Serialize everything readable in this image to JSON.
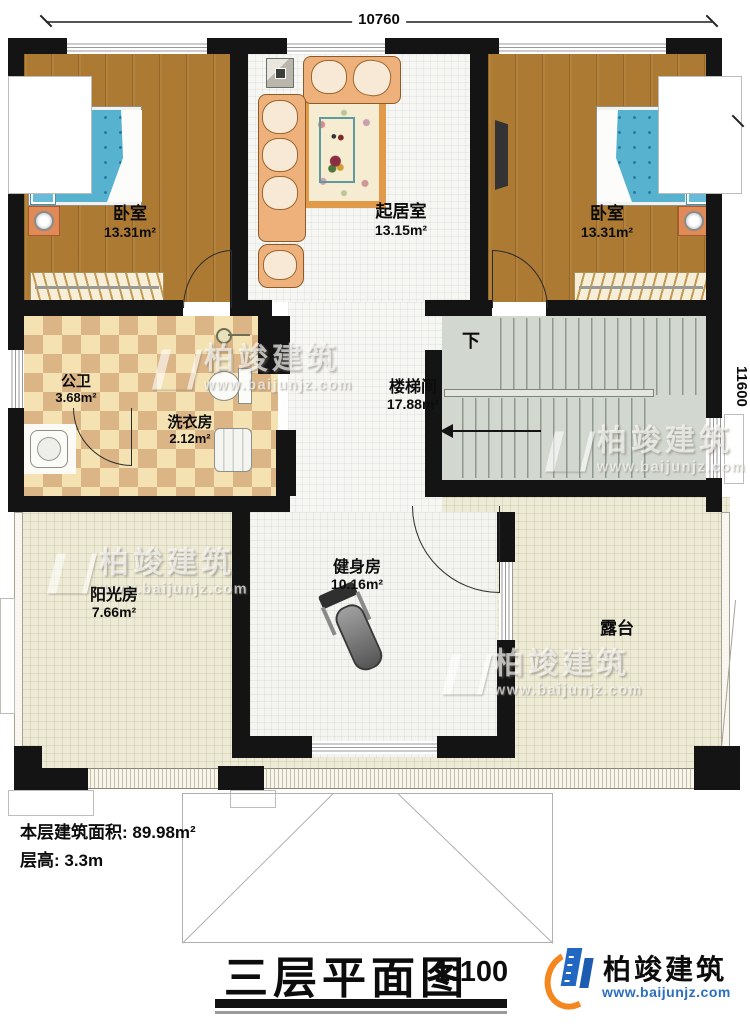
{
  "dims": {
    "width": "10760",
    "height": "11600"
  },
  "rooms": {
    "bedroom_left": {
      "name": "卧室",
      "area": "13.31m²"
    },
    "living": {
      "name": "起居室",
      "area": "13.15m²"
    },
    "bedroom_right": {
      "name": "卧室",
      "area": "13.31m²"
    },
    "bathroom": {
      "name": "公卫",
      "area": "3.68m²"
    },
    "laundry": {
      "name": "洗衣房",
      "area": "2.12m²"
    },
    "stairwell": {
      "name": "楼梯间",
      "area": "17.88m²",
      "down_label": "下"
    },
    "gym": {
      "name": "健身房",
      "area": "10.16m²"
    },
    "sunroom": {
      "name": "阳光房",
      "area": "7.66m²"
    },
    "terrace": {
      "name": "露台"
    }
  },
  "info": {
    "floor_area_label": "本层建筑面积: 89.98m²",
    "height_label": "层高: 3.3m"
  },
  "title": {
    "text": "三层平面图",
    "scale": "1:100"
  },
  "brand": {
    "name": "柏竣建筑",
    "url": "www.baijunjz.com"
  },
  "watermark": {
    "name": "柏竣建筑",
    "url": "www.baijunjz.com"
  },
  "colors": {
    "wall": "#141414",
    "wood": "#ad7a33",
    "tile_light": "#f4e2b2",
    "tile_dark": "#dcb587",
    "floor_white": "#f6f6f3",
    "stair": "#d2d7cf",
    "terrace": "#edead5",
    "mattress": "#57b2d0",
    "brand_blue": "#2268c2",
    "brand_orange": "#f5871f"
  }
}
